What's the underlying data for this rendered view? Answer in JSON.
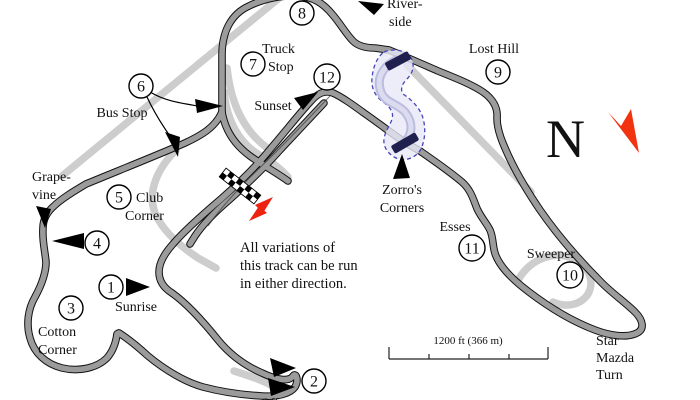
{
  "turn_numbers": [
    "1",
    "2",
    "3",
    "4",
    "5",
    "6",
    "7",
    "8",
    "9",
    "10",
    "11",
    "12"
  ],
  "labels": {
    "riverside": [
      "River-",
      "side"
    ],
    "truck_stop": [
      "Truck",
      "Stop"
    ],
    "sunset": [
      "Sunset"
    ],
    "bus_stop": [
      "Bus Stop"
    ],
    "grapevine": [
      "Grape-",
      "vine"
    ],
    "club_corner": [
      "Club",
      "Corner"
    ],
    "sunrise": [
      "Sunrise"
    ],
    "cotton_corner": [
      "Cotton",
      "Corner"
    ],
    "lost_hill": [
      "Lost Hill"
    ],
    "zorros_corners": [
      "Zorro's",
      "Corners"
    ],
    "esses": [
      "Esses"
    ],
    "sweeper": [
      "Sweeper"
    ],
    "star_mazda_turn": [
      "Star",
      "Mazda",
      "Turn"
    ],
    "off_partial": "Off-"
  },
  "note": {
    "lines": [
      "All variations of",
      "this track can be run",
      "in either direction."
    ]
  },
  "compass": {
    "label": "N"
  },
  "scale": {
    "label": "1200 ft (366 m)"
  },
  "colors": {
    "track_main": "#9b9b9b",
    "track_casing": "#111111",
    "track_alt": "#cdcdcd",
    "highlight_fill": "#e9e9f8",
    "highlight_band": "#bcbcdf",
    "highlight_border": "#4444bb",
    "closure_bar": "#20204e",
    "note_text": "#17756b",
    "direction_arrow": "#ee2211",
    "north_arrow": "#f23310"
  }
}
